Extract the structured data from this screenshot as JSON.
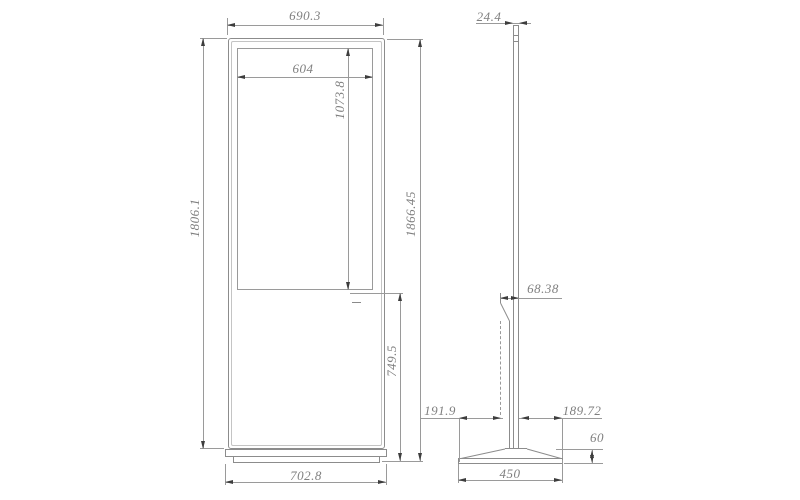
{
  "drawing": {
    "type": "technical-drawing",
    "subject": "floor-standing digital signage kiosk, front and side orthographic views",
    "colors": {
      "background": "#ffffff",
      "line": "#9a9a9a",
      "outline": "#8c8c8c",
      "text": "#7f7f7f",
      "arrow": "#3d3d3d"
    },
    "dimensions": {
      "front_width": "690.3",
      "screen_width": "604",
      "screen_height": "1073.8",
      "body_height": "1806.1",
      "overall_height": "1866.45",
      "lower_height": "749.5",
      "base_width": "702.8",
      "panel_thickness": "24.4",
      "housing_depth": "68.38",
      "base_rear": "191.9",
      "base_front": "189.72",
      "base_height": "60",
      "base_depth": "450"
    }
  }
}
